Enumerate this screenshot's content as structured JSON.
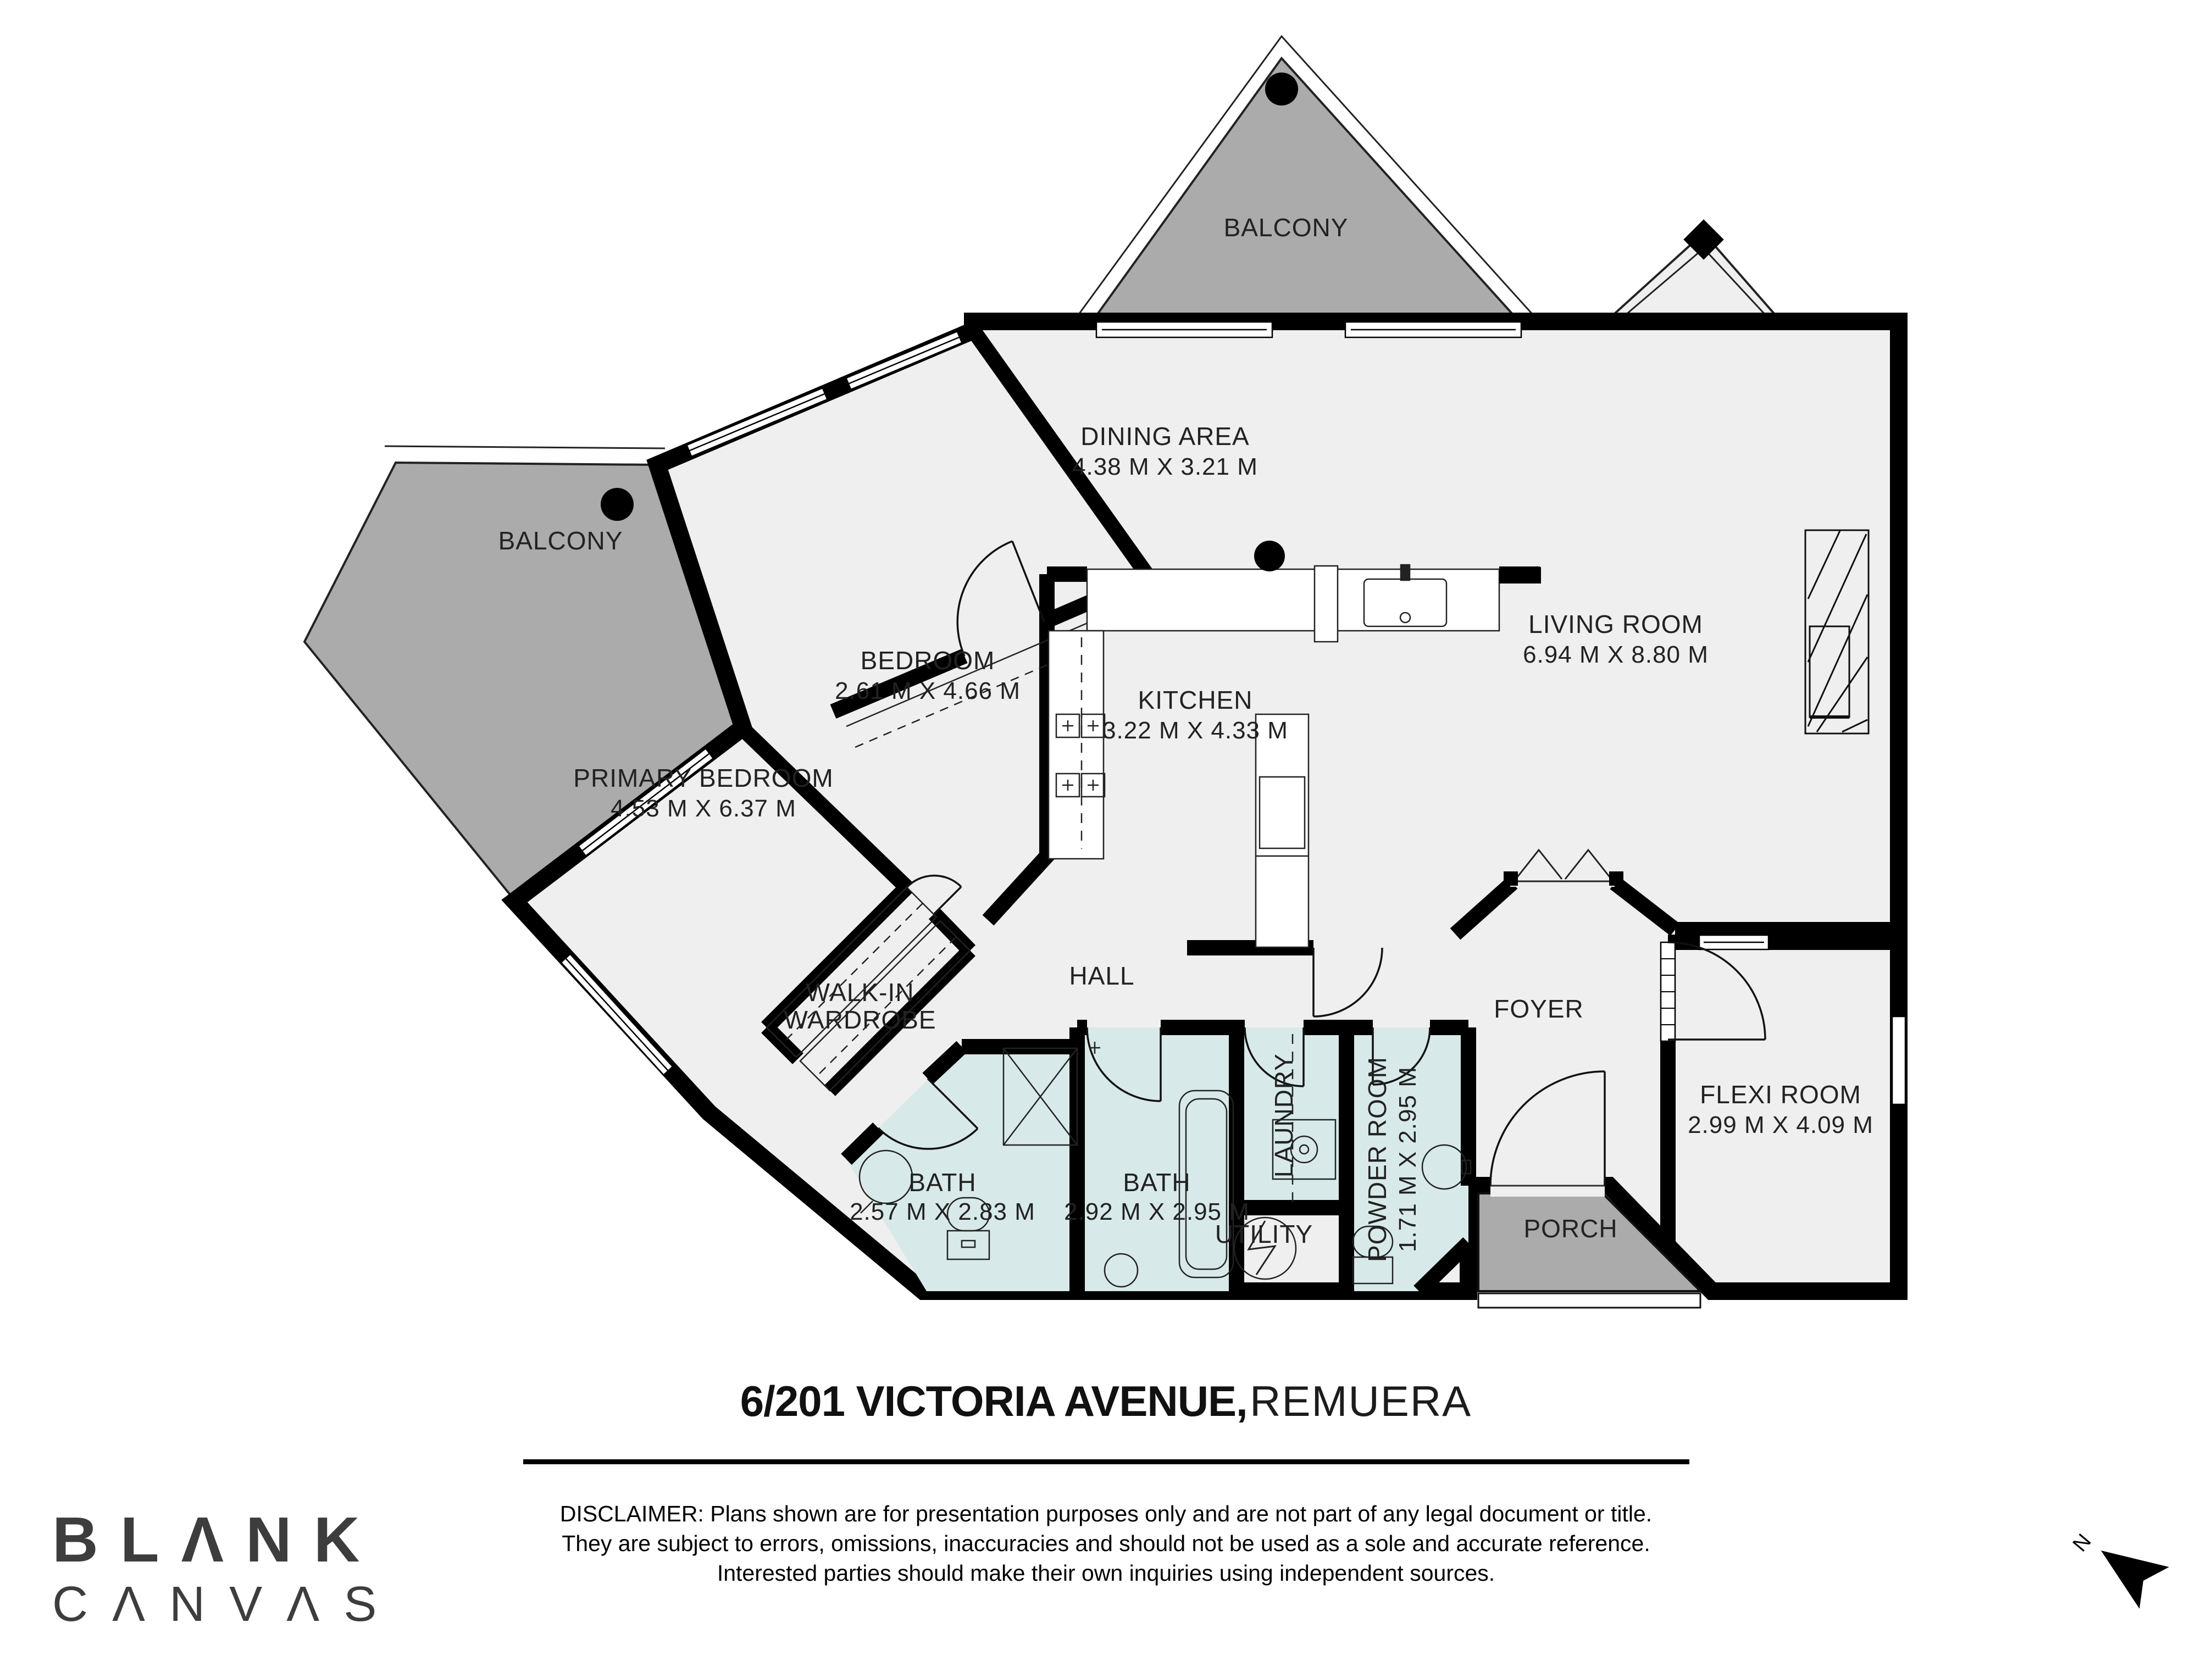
{
  "header": {
    "address_bold": "6/201 VICTORIA AVENUE,",
    "address_suffix": "REMUERA"
  },
  "plan": {
    "north_label": "N",
    "rooms": [
      {
        "id": "balcony-top",
        "name": "BALCONY"
      },
      {
        "id": "balcony-left",
        "name": "BALCONY"
      },
      {
        "id": "dining",
        "name": "DINING AREA",
        "dims": "4.38 M X 3.21 M"
      },
      {
        "id": "living",
        "name": "LIVING ROOM",
        "dims": "6.94 M X 8.80 M"
      },
      {
        "id": "bedroom",
        "name": "BEDROOM",
        "dims": "2.61 M X 4.66 M"
      },
      {
        "id": "kitchen",
        "name": "KITCHEN",
        "dims": "3.22 M X 4.33 M"
      },
      {
        "id": "primary-bedroom",
        "name": "PRIMARY BEDROOM",
        "dims": "4.53 M X 6.37 M"
      },
      {
        "id": "walk-in-wardrobe",
        "name": "WALK-IN",
        "name2": "WARDROBE"
      },
      {
        "id": "hall",
        "name": "HALL"
      },
      {
        "id": "foyer",
        "name": "FOYER"
      },
      {
        "id": "flexi-room",
        "name": "FLEXI ROOM",
        "dims": "2.99 M X 4.09 M"
      },
      {
        "id": "bath-ensuite",
        "name": "BATH",
        "dims": "2.57 M X 2.83 M"
      },
      {
        "id": "bath-main",
        "name": "BATH",
        "dims": "2.92 M X 2.95 M"
      },
      {
        "id": "laundry",
        "name": "LAUNDRY"
      },
      {
        "id": "powder-room",
        "name": "POWDER ROOM",
        "dims": "1.71 M X 2.95 M"
      },
      {
        "id": "utility",
        "name": "UTILITY"
      },
      {
        "id": "porch",
        "name": "PORCH"
      }
    ]
  },
  "footer": {
    "brand_line1": "BLΛNK",
    "brand_line2": "CΛNVΛS",
    "disclaimer_line1": "DISCLAIMER: Plans shown are for presentation purposes only and are not part of any legal document or title.",
    "disclaimer_line2": "They are subject to errors, omissions, inaccuracies and should not be used as a sole and accurate reference.",
    "disclaimer_line3": "Interested parties should make their own inquiries using independent sources."
  },
  "colors": {
    "floor": "#efefef",
    "balcony": "#ababab",
    "wet_room": "#d8e9e9",
    "wall": "#000000",
    "label_text": "#222222"
  }
}
